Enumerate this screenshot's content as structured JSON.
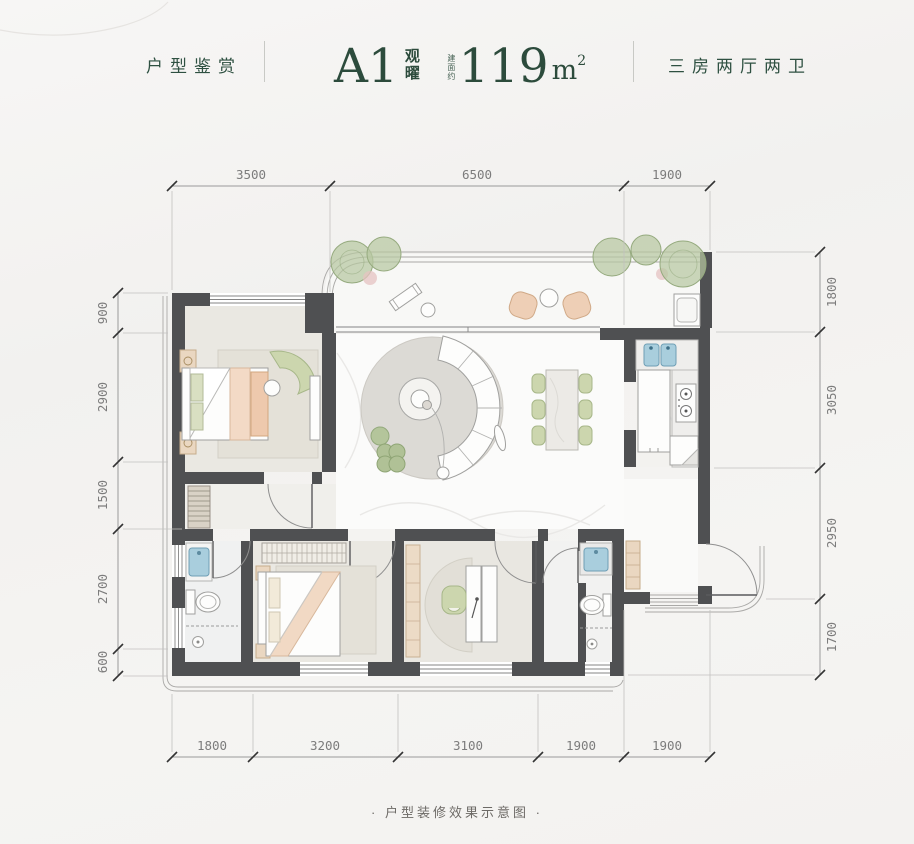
{
  "header": {
    "section_label": "户型鉴赏",
    "unit_code": "A1",
    "unit_name_chars": [
      "观",
      "曜"
    ],
    "area_prefix": "建面约",
    "area_value": "119",
    "area_unit": "m",
    "area_unit_exp": "2",
    "layout_label": "三房两厅两卫"
  },
  "dimensions": {
    "top": [
      "3500",
      "6500",
      "1900"
    ],
    "left": [
      "900",
      "2900",
      "1500",
      "2700",
      "600"
    ],
    "right": [
      "1800",
      "3050",
      "2950",
      "1700"
    ],
    "bottom": [
      "1800",
      "3200",
      "3100",
      "1900",
      "1900"
    ]
  },
  "caption": "· 户型装修效果示意图 ·",
  "colors": {
    "accent_green": "#2e5041",
    "wall": "#4f5052",
    "dimension_text": "#7c7c7c",
    "furniture_green": "#ccd6ae",
    "furniture_peach": "#eecfb6",
    "fixture_blue": "#a9cedd"
  }
}
